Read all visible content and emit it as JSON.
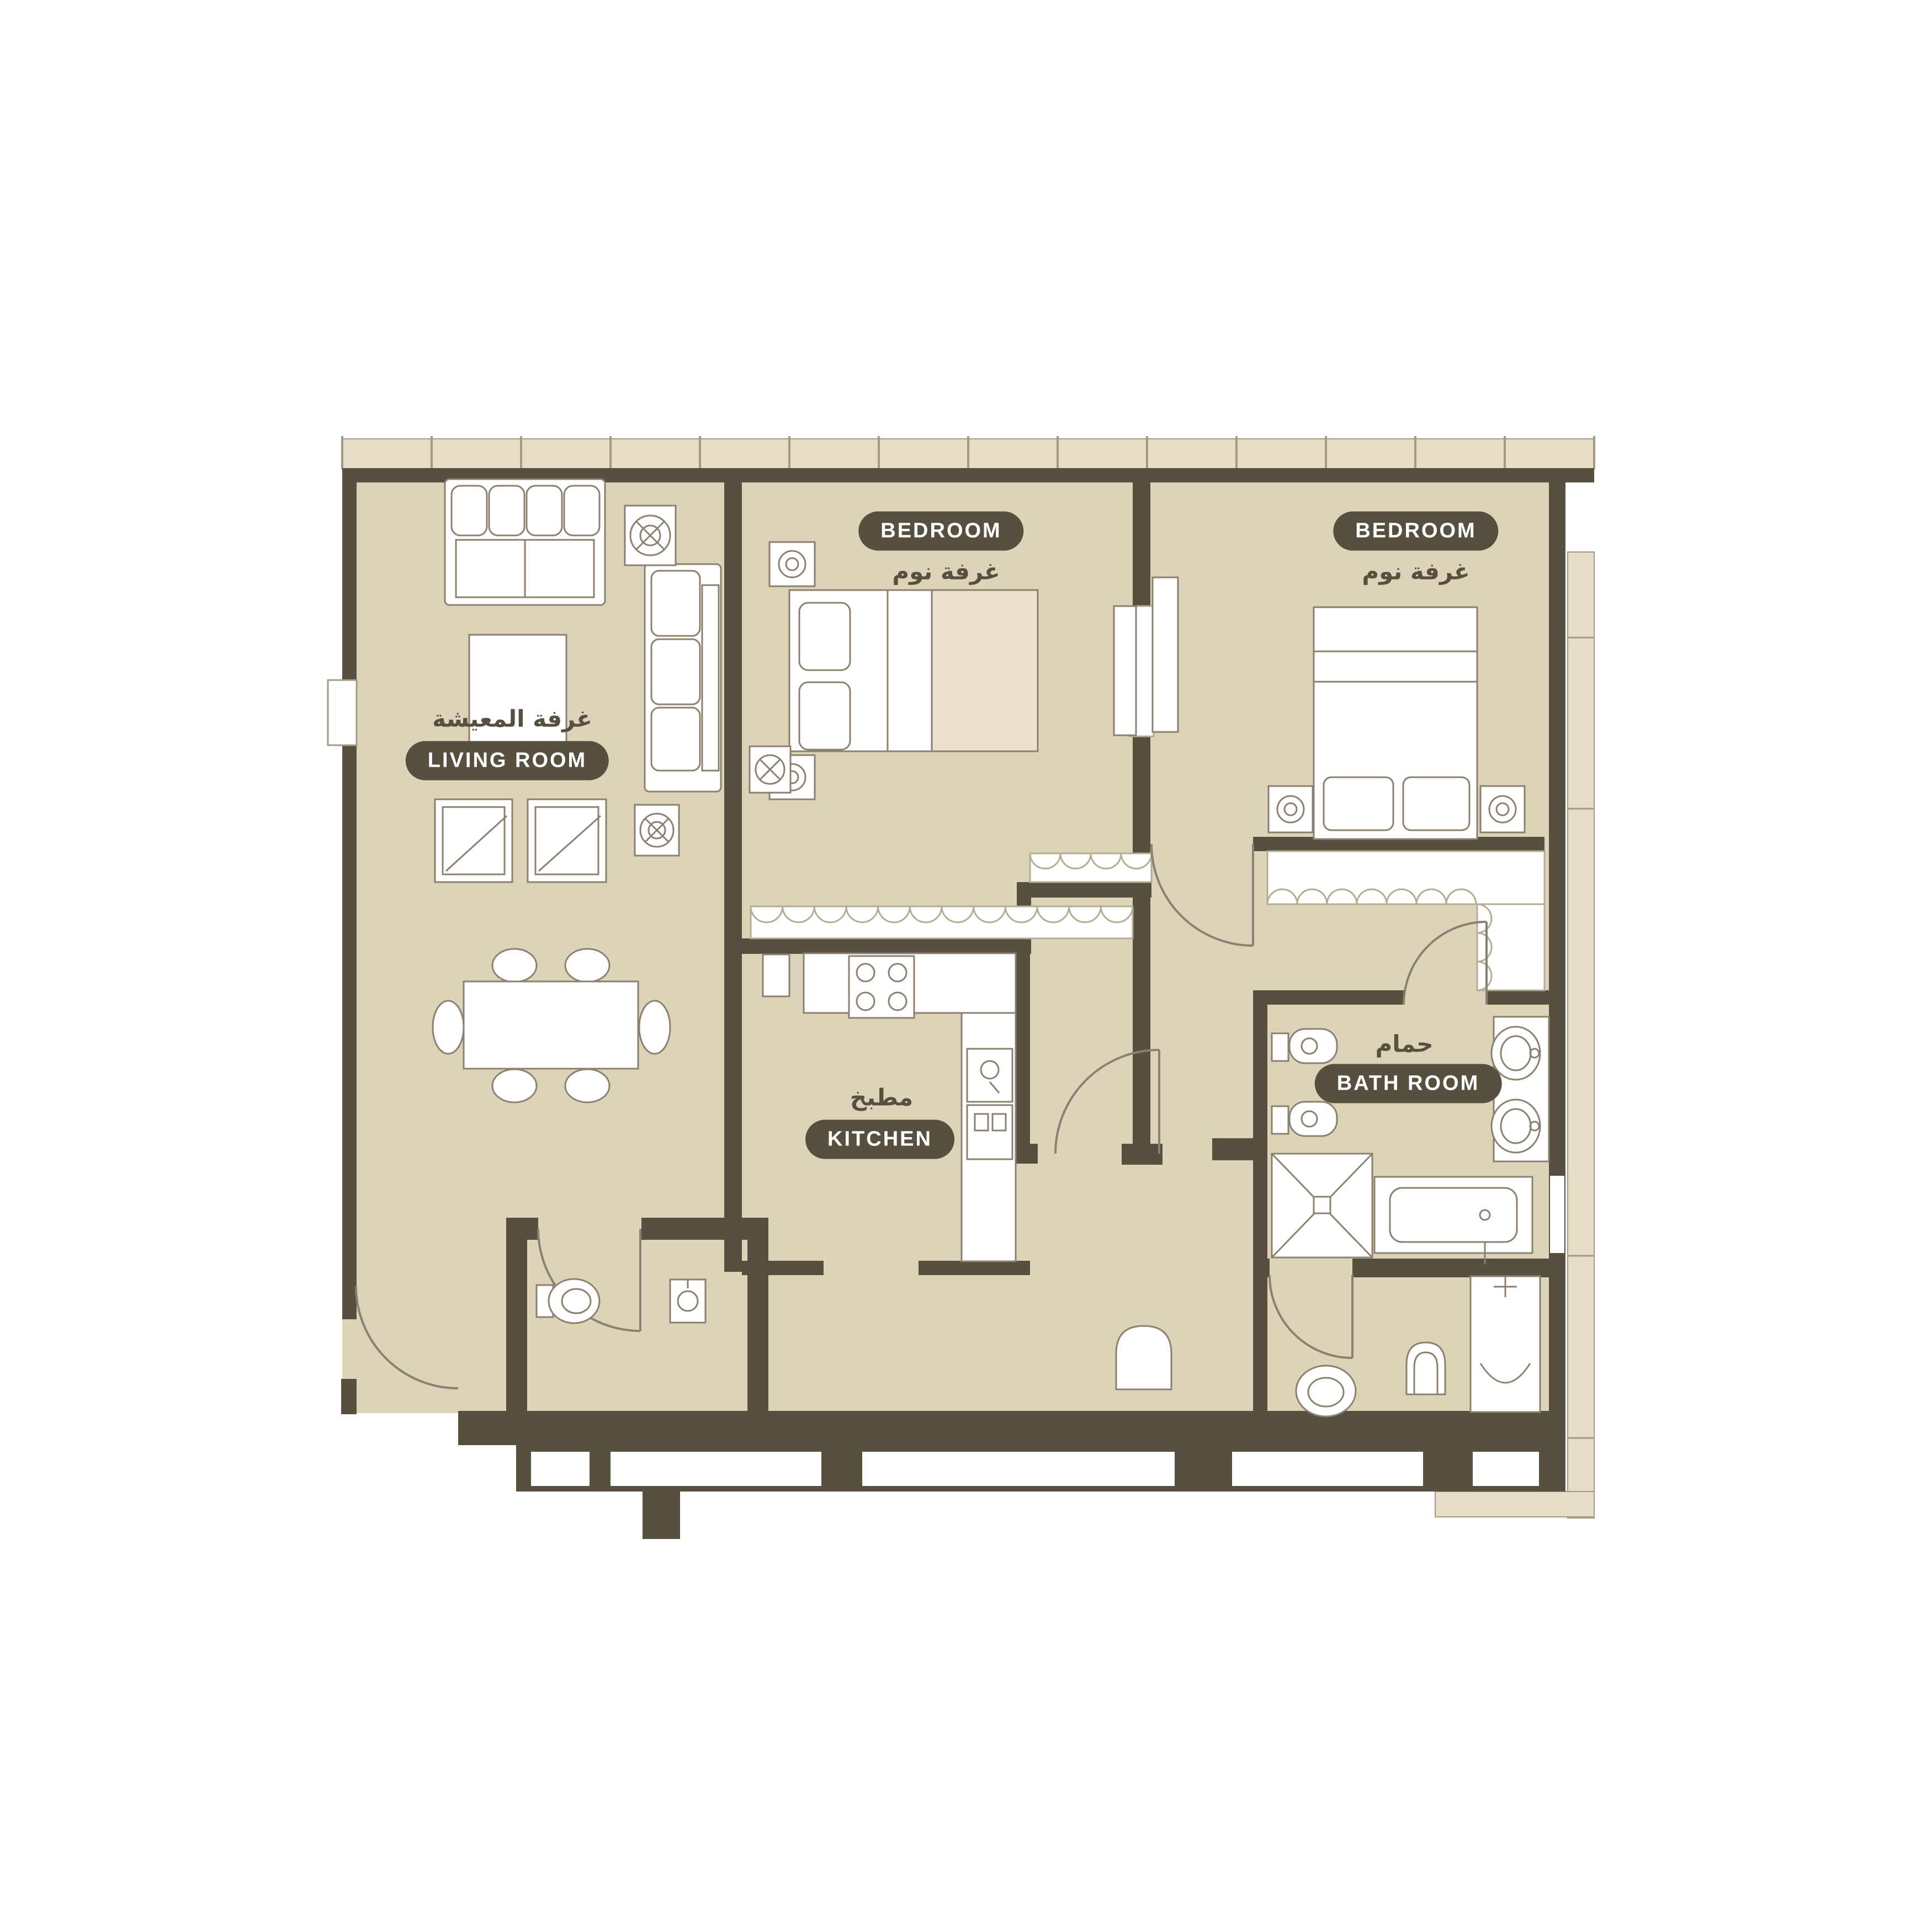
{
  "plan": {
    "type": "apartment-floor-plan",
    "colors": {
      "floor": "#ddd3b9",
      "wall": "#57503f",
      "furniture_stroke": "#8c8170",
      "window_band": "#e6ddc6",
      "band_line": "#a49a82",
      "white": "#ffffff",
      "blanket": "#eae2cd",
      "pill_bg": "#57503f",
      "pill_text": "#ffffff",
      "arabic_text": "#57503f"
    },
    "labels": {
      "living": {
        "en": "LIVING ROOM",
        "ar": "غرفة المعيشة"
      },
      "bedroom1": {
        "en": "BEDROOM",
        "ar": "غرفة نوم"
      },
      "bedroom2": {
        "en": "BEDROOM",
        "ar": "غرفة نوم"
      },
      "kitchen": {
        "en": "KITCHEN",
        "ar": "مطبخ"
      },
      "bathroom": {
        "en": "BATH ROOM",
        "ar": "حمام"
      }
    }
  }
}
